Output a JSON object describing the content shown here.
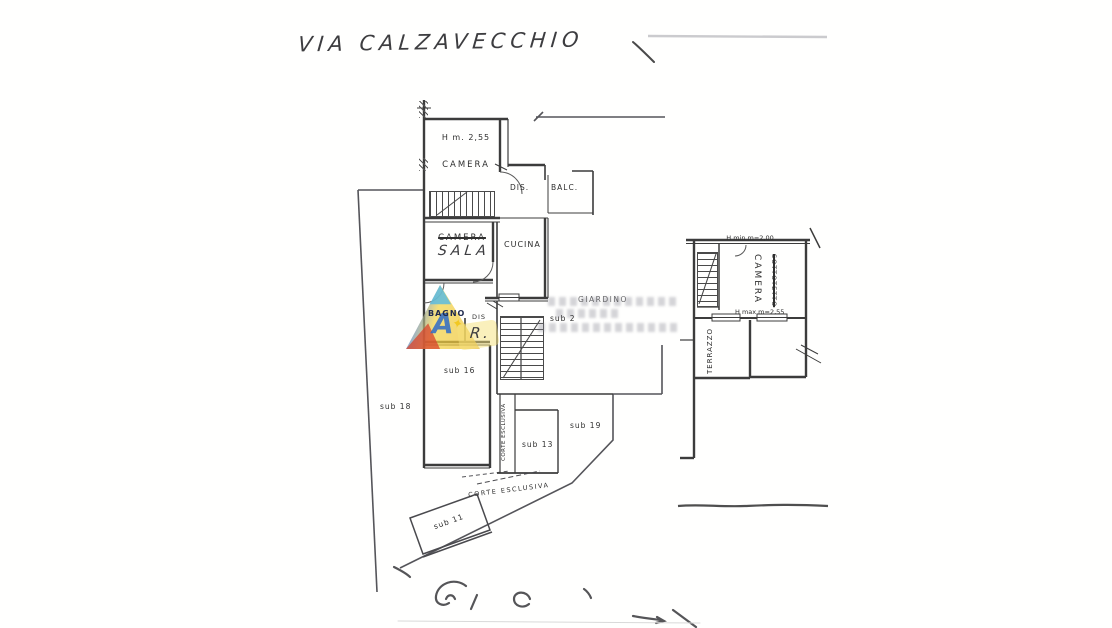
{
  "page": {
    "background": "#ffffff"
  },
  "handwritten": {
    "street_label": "VIA CALZAVECCHIO",
    "sala_label": "SALA",
    "r_label": "R."
  },
  "ground_plan": {
    "camera": "CAMERA",
    "camera_height_note": "H m. 2,55",
    "dis_upper": "DIS.",
    "balc": "BALC.",
    "camera_struck": "CAMERA",
    "cucina": "CUCINA",
    "bagno": "BAGNO",
    "dis_lower": "DIS",
    "giardino": "GIARDINO",
    "sub_2": "sub 2",
    "sub_16": "sub 16",
    "sub_18": "sub 18",
    "sub_13": "sub 13",
    "sub_19": "sub 19",
    "sub_11": "sub 11",
    "corte_esclusiva_strip": "CORTE ESCLUSIVA",
    "corte_esclusiva_area": "CORTE ESCLUSIVA"
  },
  "attic_plan": {
    "sottotetto_struck": "SOTTOTETTO",
    "camera": "CAMERA",
    "h_min_note": "H min m=2,00",
    "h_max_note": "H max m=2,55",
    "terrazzo": "TERRAZZO"
  },
  "watermark": {
    "letter": "A",
    "star_glyph": "✦",
    "colors": {
      "blue": "#3a6fc9",
      "cyan": "#54b9e6",
      "yellow": "#f2d23c",
      "red": "#d8432b"
    }
  }
}
